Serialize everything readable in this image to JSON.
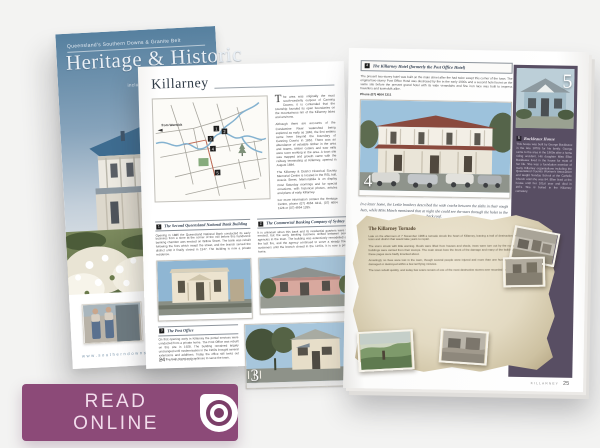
{
  "colors": {
    "button_purple": "#8c4a78",
    "panel_purple": "#584e63",
    "parchment": "#e3dac2",
    "cover_sky": "#5d87ad"
  },
  "cover": {
    "kicker": "Queensland's Southern Downs & Granite Belt",
    "title": "Heritage & Historic",
    "subtitle": "BUILDINGS",
    "tagline": "including Southern Darling Downs",
    "website": "www.southerndownsandgranitebelt.com.au"
  },
  "spread": {
    "left_page": {
      "title": "Killarney",
      "map": {
        "from_label": "from Warwick",
        "markers": [
          "1",
          "2",
          "3",
          "4",
          "5"
        ]
      },
      "intro": {
        "dropcap": "T",
        "p1": "he area was originally the most south-westerly outpost of Canning Downs; it is contended that the township founded its open boundaries on the mountainous rim of the Killarney lakes and environs.",
        "p2": "Although there are accounts of the Condamine River watershed being explored as early as 1840, the first settlers came here beyond the boundary of Canning Downs in 1862. There was an abundance of valuable timber in the area and teams, timber cutters and saw mills were soon working in the area. A town site was mapped and growth came with the railway terminating at Killarney, opened in August 1884.",
        "p3": "The Killarney & District Historical Society Memorial Centre is located in the RSL hall, Acacia Street. Memorabilia is on display most Saturday mornings and for special occasions, with historical photos, articles and plans of early Killarney.",
        "p4": "For more information contact the Heritage Centre, phone (07) 4664 4311, (07) 4664 1128 or (07) 4664 1285."
      },
      "sections": [
        {
          "num": "1",
          "heading": "The Second Queensland National Bank Building",
          "body": "Opening in 1886 the Queensland National Bank conducted its early business from a store at the corner of the mill before this handsome banking chamber was erected on Willow Street. The bank was rebuilt following the fires which swept the street, and the branch served the district until it finally closed in 1947. The building is now a private residence."
        },
        {
          "num": "2",
          "heading": "The Commercial Banking Company of Sydney",
          "body": "It is unknown when this bank and its residential quarters were first erected, but the early banking business shifted between several agencies in the town. The building was extensively remodelled after the last fire, and the agency continued to serve a steady flow of customers until the branch closed in the 1970s. It is now a private home."
        },
        {
          "num": "3",
          "heading": "The Post Office",
          "body": "On first opening early in Killarney the postal services were conducted from a private home. The Post Office was rebuilt on this site in 1928. The building remained largely unchanged until modernisation in the 1960s brought several extensions and additions. Today the office still looks out over the main street and continues to serve the town."
        }
      ],
      "footer": {
        "page": "24",
        "label": "KILLARNEY"
      }
    },
    "right_page": {
      "section4": {
        "num": "4",
        "heading": "The Killarney Hotel (formerly the Post Office Hotel)",
        "body": "The present two-storey hotel was built on the main street after fire had twice swept this corner of the town. The original two-storey Post Office Hotel was destroyed by fire in the early 1900s and a second hotel burnt on the same site before the present grand hotel with its wide verandahs and fine iron lace was built to impress travellers and townsfolk alike.",
        "phone": "Phone (07) 4664 1311"
      },
      "quote": "In a letter home, the Leslie brothers described the wide cracks between the slabs in their rough huts, while Miss March mentioned that at night she could see the stars through the holes in the bark roof.",
      "section5": {
        "num": "5",
        "heading": "Buckleaux House",
        "body": "This house was built by George Buckleaux in the late 1870s for his family. George came to the area in the 1860s after a horse riding accident. His daughter Miss Ellen Buckleaux lived in the house for most of her life. She was a foundation member of many Killarney organisations including the Queensland Country Women's Association and taught Sunday School at the Catholic Church until she was 84. Ellen lived at the house until her 101st year and died in 1971. She is buried in the Killarney cemetery."
      },
      "tornado": {
        "title": "The Killarney Tornado",
        "p1": "Late on the afternoon of 7 November 1968 a tornado struck the heart of Killarney, leaving a trail of destruction through the town and district that would take years to repair.",
        "p2": "The storm struck with little warning. Roofs were lifted from houses and sheds, trees were torn out by the roots and whole buildings were carried from their stumps. The main street bore the brunt of the damage and many of the buildings shown on these pages were badly knocked about.",
        "p3": "Amazingly no lives were lost in the town, though several people were injured and more than one hundred buildings were damaged or destroyed within a few terrifying minutes.",
        "p4": "The town rebuilt quickly, and today few scars remain of one of the most destructive storms ever recorded in Queensland."
      },
      "footer": {
        "label": "KILLARNEY",
        "page": "25"
      }
    }
  },
  "read_online": {
    "label": "READ ONLINE"
  }
}
